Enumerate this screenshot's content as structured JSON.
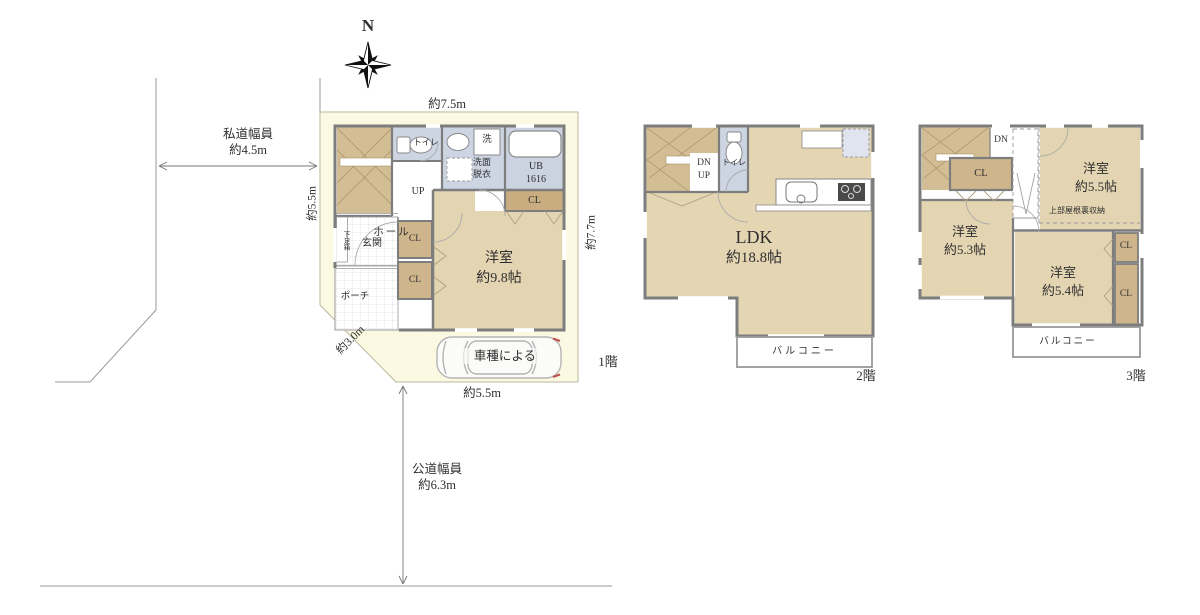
{
  "site": {
    "compass": "N",
    "private_road1": "私道幅員",
    "private_road2": "約4.5m",
    "public_road1": "公道幅員",
    "public_road2": "約6.3m",
    "dim_top": "約7.5m",
    "dim_left": "約5.5m",
    "dim_right": "約7.7m",
    "dim_diag": "約3.0m",
    "dim_bottom": "約5.5m"
  },
  "f1": {
    "floor_label": "1階",
    "toilet": "トイレ",
    "laundry": "洗",
    "washroom1": "洗面",
    "washroom2": "脱衣",
    "bath1": "UB",
    "bath2": "1616",
    "cl_bath": "CL",
    "up": "UP",
    "hall": "ホール",
    "entrance": "玄関",
    "shoebox": "下足箱",
    "cl_a": "CL",
    "cl_b": "CL",
    "porch": "ポーチ",
    "bedroom_name": "洋室",
    "bedroom_size": "約9.8帖",
    "car_note": "車種による"
  },
  "f2": {
    "floor_label": "2階",
    "dn": "DN",
    "up": "UP",
    "toilet": "トイレ",
    "ldk_name": "LDK",
    "ldk_size": "約18.8帖",
    "balcony": "バルコニー"
  },
  "f3": {
    "floor_label": "3階",
    "dn": "DN",
    "cl_hall": "CL",
    "b1_name": "洋室",
    "b1_size": "約5.5帖",
    "attic": "上部屋根裏収納",
    "b2_name": "洋室",
    "b2_size": "約5.3帖",
    "b3_name": "洋室",
    "b3_size": "約5.4帖",
    "cl1": "CL",
    "cl2": "CL",
    "balcony": "バルコニー"
  },
  "colors": {
    "plot": "#fbf9e2",
    "wall": "#7d7d7d",
    "room_tan": "#e3d4b2",
    "closet_tan": "#cfb58c",
    "stairs_tan": "#d3bd94",
    "wet_blue": "#cdd5e3",
    "fridge_blue": "#dfe4ee",
    "thin_line": "#999999",
    "text": "#2f2f2f"
  }
}
